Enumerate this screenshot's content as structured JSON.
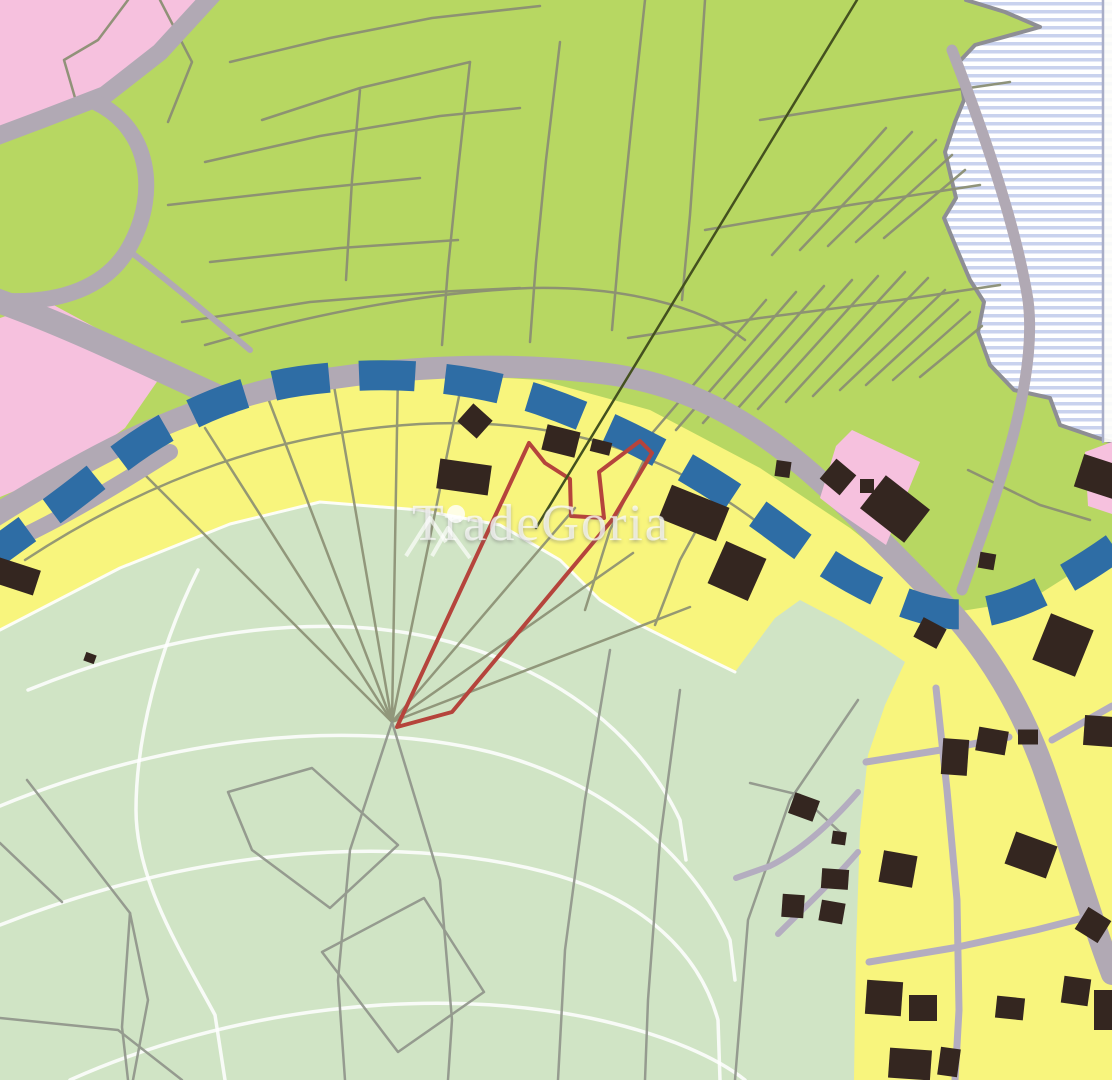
{
  "map": {
    "width": 1112,
    "height": 1080,
    "watermark": {
      "text": "TradeGoria",
      "icon": "mountain-peaks-icon"
    },
    "colors": {
      "green_zone": "#b7d762",
      "pale_green_zone": "#d0e4c5",
      "yellow_zone": "#f8f57d",
      "pink_zone": "#f6c1de",
      "water_base": "#ffffff",
      "water_stripe": "#c9d2ee",
      "coast": "#8e8e94",
      "road": "#b1a9b4",
      "street": "#b4adc0",
      "parcel_green": "#8b8f73",
      "parcel_pale": "#8f948a",
      "building": "#342620",
      "shore_dash_blue": "#2e6da5",
      "highlight_parcel_red": "#b5443c",
      "survey_line": "#44511f",
      "contour_white": "#ffffff",
      "neatline": "#a9aec8"
    },
    "layers": [
      {
        "tag": "rect",
        "x": 0,
        "y": 0,
        "w": 1112,
        "h": 1080,
        "fill": "#b7d762"
      },
      {
        "tag": "polygon",
        "fill": "pattern:wstripes",
        "points": "966,0 1112,0 1112,442 1098,438 1060,425 1050,398 1014,390 990,365 978,332 984,302 970,280 958,252 944,218 956,198 945,152 955,122 964,100 959,62 975,45 1040,27 1005,12"
      },
      {
        "tag": "path",
        "stroke": "#8e8e94",
        "w": 4,
        "d": "M966,0 L1005,12 L1040,27 L975,45 L959,62 L964,100 L955,122 L945,152 L956,198 L944,218 L958,252 L970,280 L984,302 L978,332 L990,365 L1014,390 L1050,398 L1060,425 L1098,438 L1112,442"
      },
      {
        "tag": "rect",
        "x": 1102,
        "y": 0,
        "w": 10,
        "h": 442,
        "fill": "#fdfdfa",
        "opacity": 0.9
      },
      {
        "tag": "path",
        "stroke": "#a9aec8",
        "w": 2.5,
        "d": "M1103,0 L1103,442"
      },
      {
        "tag": "polygon",
        "fill": "#f6c1de",
        "points": "0,0 207,0 160,58 120,88 62,112 30,122 0,133"
      },
      {
        "tag": "polygon",
        "fill": "#f6c1de",
        "points": "0,318 48,302 100,330 163,373 125,428 70,468 0,497"
      },
      {
        "tag": "polygon",
        "fill": "#f8f57d",
        "points": "0,505 90,452 180,412 280,387 400,372 540,380 650,410 760,468 850,528 905,572 955,612 1030,600 1112,548 1112,1080 0,1080"
      },
      {
        "tag": "polygon",
        "fill": "#d0e4c5",
        "points": "0,630 120,568 230,524 320,502 420,510 500,525 560,560 600,600 640,625 700,655 735,672 775,618 800,600 842,622 880,645 905,662 885,705 868,755 860,830 856,950 854,1080 0,1080"
      },
      {
        "tag": "path",
        "stroke": "#ffffff",
        "w": 3,
        "opacity": 0.9,
        "d": "M0,630 L120,568 L230,524 L320,502 L420,510 L500,525 L560,560 L600,600 L640,625 L700,655 L735,672"
      },
      {
        "tag": "path",
        "stroke": "#ffffff",
        "w": 3.5,
        "opacity": 0.85,
        "d": "M28,690 C180,628 330,610 450,642 C560,672 640,735 680,820 L686,860"
      },
      {
        "tag": "path",
        "stroke": "#ffffff",
        "w": 3.5,
        "opacity": 0.85,
        "d": "M0,806 C170,736 350,718 490,752 C600,780 690,850 730,940 L735,980"
      },
      {
        "tag": "path",
        "stroke": "#ffffff",
        "w": 3.5,
        "opacity": 0.85,
        "d": "M0,925 C190,850 390,832 545,872 C645,898 700,955 718,1020 L720,1080"
      },
      {
        "tag": "path",
        "stroke": "#ffffff",
        "w": 3.5,
        "opacity": 0.85,
        "d": "M70,1080 C230,1008 430,985 590,1018 C670,1035 720,1060 745,1080"
      },
      {
        "tag": "path",
        "stroke": "#ffffff",
        "w": 3.5,
        "opacity": 0.85,
        "d": "M198,570 C158,650 136,740 136,810 C136,880 180,950 215,1015 L225,1080"
      },
      {
        "tag": "group",
        "stroke": "#8b8f73",
        "w": 2.5,
        "opacity": 0.95,
        "paths": [
          "M160,0 L192,62 L168,122",
          "M128,0 L98,40 L64,60 L78,108",
          "M230,62 L330,38 L432,18 L540,6",
          "M205,162 L320,136 L440,116 L520,108",
          "M168,205 L300,190 L420,178",
          "M210,262 L340,248 L458,240",
          "M182,322 L310,302 L435,292 L520,288",
          "M470,62 L458,170 L448,268 L442,345",
          "M560,42 L546,160 L536,262 L530,342",
          "M645,0 L632,120 L620,238 L612,330",
          "M705,0 L698,105 L690,215 L682,300",
          "M360,90 L352,180 L346,280",
          "M262,120 L360,88 L470,62",
          "M205,345 C320,312 430,292 530,288 C620,286 700,305 745,340",
          "M628,338 L760,318 L900,300 L1000,285",
          "M705,230 L850,205 L980,185",
          "M760,120 L900,98 L1010,82",
          "M648,438 L766,300",
          "M676,430 L796,292",
          "M703,423 L824,286",
          "M731,416 L852,280",
          "M758,409 L878,276",
          "M786,402 L905,272",
          "M813,396 L928,278",
          "M840,390 L945,290",
          "M866,385 L958,300",
          "M893,380 L970,312",
          "M920,377 L982,326",
          "M772,255 L886,128",
          "M800,250 L912,132",
          "M828,246 L936,140",
          "M856,242 L952,155",
          "M884,238 L965,170",
          "M968,470 L1040,505 L1090,520"
        ]
      },
      {
        "tag": "group",
        "stroke": "#8b8f73",
        "w": 2.5,
        "opacity": 0.9,
        "paths": [
          "M392,722 L140,470",
          "M392,722 L205,428",
          "M392,722 L268,398",
          "M392,722 L333,380",
          "M392,722 L398,371",
          "M392,722 L463,377",
          "M392,722 L575,508",
          "M392,722 L633,553",
          "M392,722 L690,607",
          "M648,452 L610,530 L585,610",
          "M720,487 L680,560 L655,625",
          "M25,560 C150,478 280,432 420,424 C560,417 670,452 770,532"
        ]
      },
      {
        "tag": "group",
        "stroke": "#8f948a",
        "w": 2.5,
        "opacity": 0.9,
        "paths": [
          "M27,780 L130,913 L122,1027 L128,1080",
          "M0,843 L62,902",
          "M133,1080 L148,1000 L130,913",
          "M228,792 L312,768 L398,845 L330,908 L252,850 Z",
          "M322,952 L424,898 L484,992 L398,1052 Z",
          "M392,722 L350,850 L338,980 L345,1080",
          "M392,722 L440,880 L452,1020 L448,1080",
          "M610,650 L585,800 L565,950 L558,1080",
          "M680,690 L660,840 L648,1000 L645,1080",
          "M858,700 L790,800 L748,920 L735,1080",
          "M0,1018 L118,1030 L182,1080",
          "M750,783 L800,795 L840,832"
        ]
      },
      {
        "tag": "group",
        "stroke": "#b1a9b4",
        "w": 18,
        "paths": [
          "M215,-8 L160,52 L105,95 L40,120 L-8,138"
        ]
      },
      {
        "tag": "group",
        "stroke": "#b1a9b4",
        "w": 16,
        "paths": [
          "M95,102 C150,128 158,192 132,242 C110,287 60,306 -8,300"
        ]
      },
      {
        "tag": "group",
        "stroke": "#b1a9b4",
        "w": 24,
        "paths": [
          "M-10,298 C70,326 150,366 230,402"
        ]
      },
      {
        "tag": "group",
        "stroke": "#b1a9b4",
        "w": 6,
        "paths": [
          "M128,250 C170,282 210,316 250,350"
        ]
      },
      {
        "tag": "group",
        "stroke": "#b1a9b4",
        "w": 22,
        "paths": [
          "M-12,520 C80,462 170,412 280,387 C390,366 500,361 600,373 C690,383 762,426 832,492 C882,541 916,576 952,613 C986,651 1022,706 1046,776 C1069,843 1092,922 1112,974"
        ]
      },
      {
        "tag": "group",
        "stroke": "#b1a9b4",
        "w": 16,
        "paths": [
          "M-12,552 C50,526 110,490 170,452"
        ]
      },
      {
        "tag": "group",
        "stroke": "#b1a9b4",
        "w": 11,
        "paths": [
          "M952,50 C985,135 1016,226 1028,300 C1038,378 1002,480 962,590"
        ]
      },
      {
        "tag": "group",
        "stroke": "#b4adc0",
        "w": 6,
        "paths": [
          "M858,792 C832,822 802,850 770,866 L736,878",
          "M858,852 C832,882 806,906 778,934"
        ]
      },
      {
        "tag": "group",
        "stroke": "#b4adc0",
        "w": 7,
        "paths": [
          "M936,688 L947,790 L957,900 L959,1010 L955,1080",
          "M866,762 L941,750 L1009,737",
          "M869,962 L953,948 L1036,930 L1091,916",
          "M1052,740 L1112,706"
        ]
      },
      {
        "tag": "path",
        "stroke": "#2e6da5",
        "w": 30,
        "dash": "56 30",
        "cap": "butt",
        "d": "M-18,562 C40,520 75,495 105,470 C160,425 225,392 300,381 C380,370 462,374 540,400 C618,427 700,470 780,530 C840,576 900,608 950,614 C1000,618 1062,586 1125,540"
      },
      {
        "tag": "path",
        "stroke": "#b5443c",
        "w": 4,
        "d": "M397,727 L529,443 L545,463 L570,479 L571,516 L604,518 L599,472 L640,441 L652,453 L612,520 L452,712 Z"
      },
      {
        "tag": "path",
        "stroke": "#b5443c",
        "w": 3,
        "d": "M397,727 L438,716"
      },
      {
        "tag": "path",
        "stroke": "#44511f",
        "w": 2.5,
        "d": "M857,0 L536,528"
      },
      {
        "tag": "polygon",
        "fill": "#f6c1de",
        "points": "852,430 920,462 886,545 838,512 820,498 836,446"
      },
      {
        "tag": "polygon",
        "fill": "#f6c1de",
        "points": "1085,452 1112,442 1112,514 1088,506"
      },
      {
        "tag": "buildings",
        "fill": "#342620",
        "items": [
          [
            15,
            576,
            46,
            26,
            18
          ],
          [
            90,
            658,
            11,
            9,
            20
          ],
          [
            475,
            421,
            26,
            24,
            42
          ],
          [
            464,
            477,
            52,
            30,
            8
          ],
          [
            561,
            441,
            34,
            26,
            14
          ],
          [
            601,
            447,
            20,
            13,
            14
          ],
          [
            694,
            513,
            62,
            36,
            22
          ],
          [
            737,
            571,
            44,
            46,
            24
          ],
          [
            783,
            469,
            15,
            16,
            8
          ],
          [
            838,
            477,
            26,
            26,
            40
          ],
          [
            867,
            486,
            14,
            14,
            0
          ],
          [
            895,
            509,
            56,
            42,
            38
          ],
          [
            1100,
            477,
            44,
            34,
            18
          ],
          [
            987,
            561,
            16,
            16,
            10
          ],
          [
            930,
            633,
            26,
            22,
            28
          ],
          [
            1063,
            645,
            46,
            50,
            22
          ],
          [
            1099,
            731,
            30,
            30,
            4
          ],
          [
            992,
            741,
            30,
            24,
            10
          ],
          [
            1028,
            737,
            20,
            15,
            0
          ],
          [
            955,
            757,
            26,
            36,
            4
          ],
          [
            1031,
            855,
            44,
            34,
            20
          ],
          [
            898,
            869,
            34,
            32,
            10
          ],
          [
            1093,
            925,
            27,
            26,
            32
          ],
          [
            1076,
            991,
            27,
            27,
            8
          ],
          [
            1106,
            1010,
            24,
            40,
            0
          ],
          [
            884,
            998,
            36,
            34,
            4
          ],
          [
            923,
            1008,
            28,
            26,
            0
          ],
          [
            1010,
            1008,
            28,
            22,
            6
          ],
          [
            910,
            1064,
            42,
            30,
            4
          ],
          [
            949,
            1062,
            20,
            28,
            8
          ],
          [
            804,
            807,
            26,
            22,
            20
          ],
          [
            839,
            838,
            14,
            13,
            8
          ],
          [
            835,
            879,
            27,
            20,
            4
          ],
          [
            793,
            906,
            22,
            23,
            4
          ],
          [
            832,
            912,
            24,
            21,
            10
          ]
        ]
      }
    ]
  }
}
